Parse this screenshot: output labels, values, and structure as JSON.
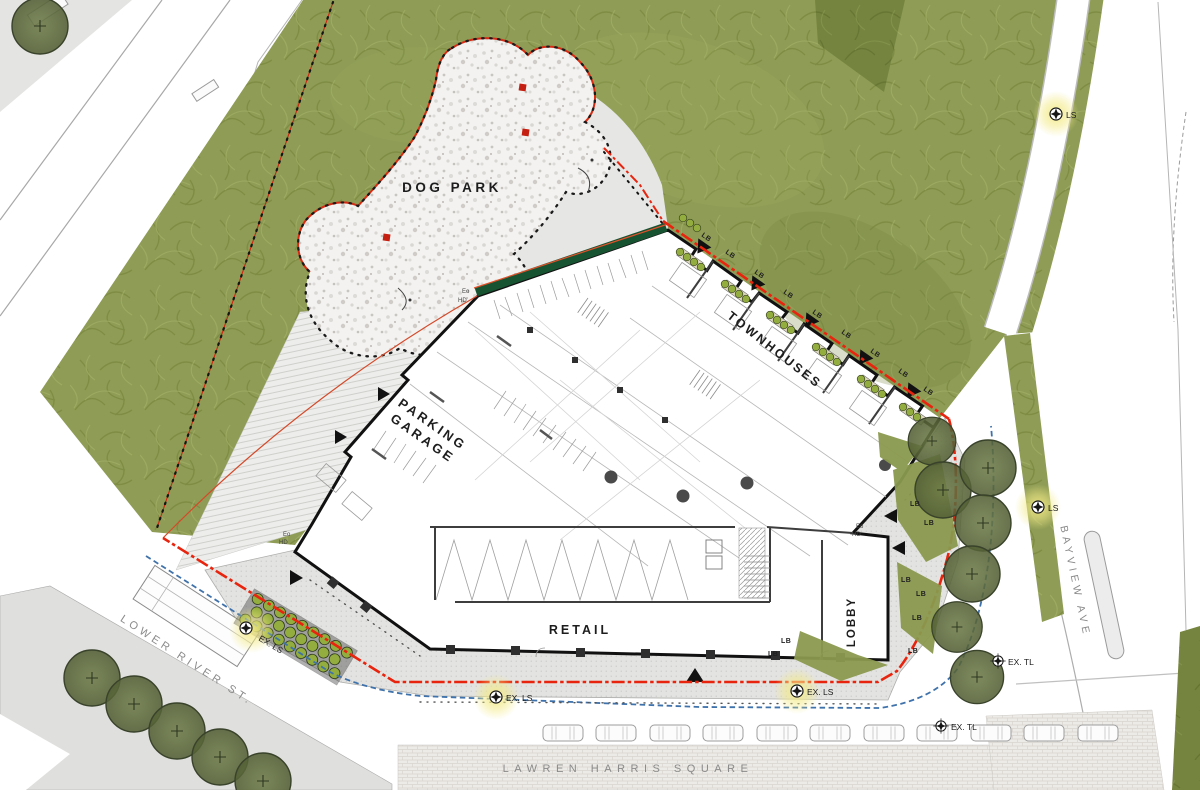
{
  "plan": {
    "areas": {
      "dog_park": "DOG PARK",
      "parking_garage_line1": "PARKING",
      "parking_garage_line2": "GARAGE",
      "townhouses": "TOWNHOUSES",
      "retail": "RETAIL",
      "lobby": "LOBBY"
    },
    "streets": {
      "lower_river_st": "LOWER RIVER ST.",
      "bayview_ave": "BAYVIEW AVE",
      "lawren_harris_square": "LAWREN HARRIS SQUARE"
    },
    "annotations": {
      "lb": "LB",
      "ls": "LS",
      "ex_ls": "EX. LS",
      "ex_tl": "EX. TL",
      "eo": "Eo",
      "hd": "HD"
    },
    "colors": {
      "grass": "#8e9c55",
      "grass_dark": "#75843f",
      "tree_canopy": "#5f6d40",
      "shrub": "#93ad3e",
      "hedge": "#175231",
      "gravel": "#f3f2f0",
      "property_line_red": "#e8240e",
      "setback_line_blue": "#3f72ab",
      "building_outline": "#111111",
      "sidewalk": "#e3e3e1",
      "road": "#ffffff",
      "square_paving": "#edebe7",
      "light_glow": "#f5e97a"
    }
  }
}
